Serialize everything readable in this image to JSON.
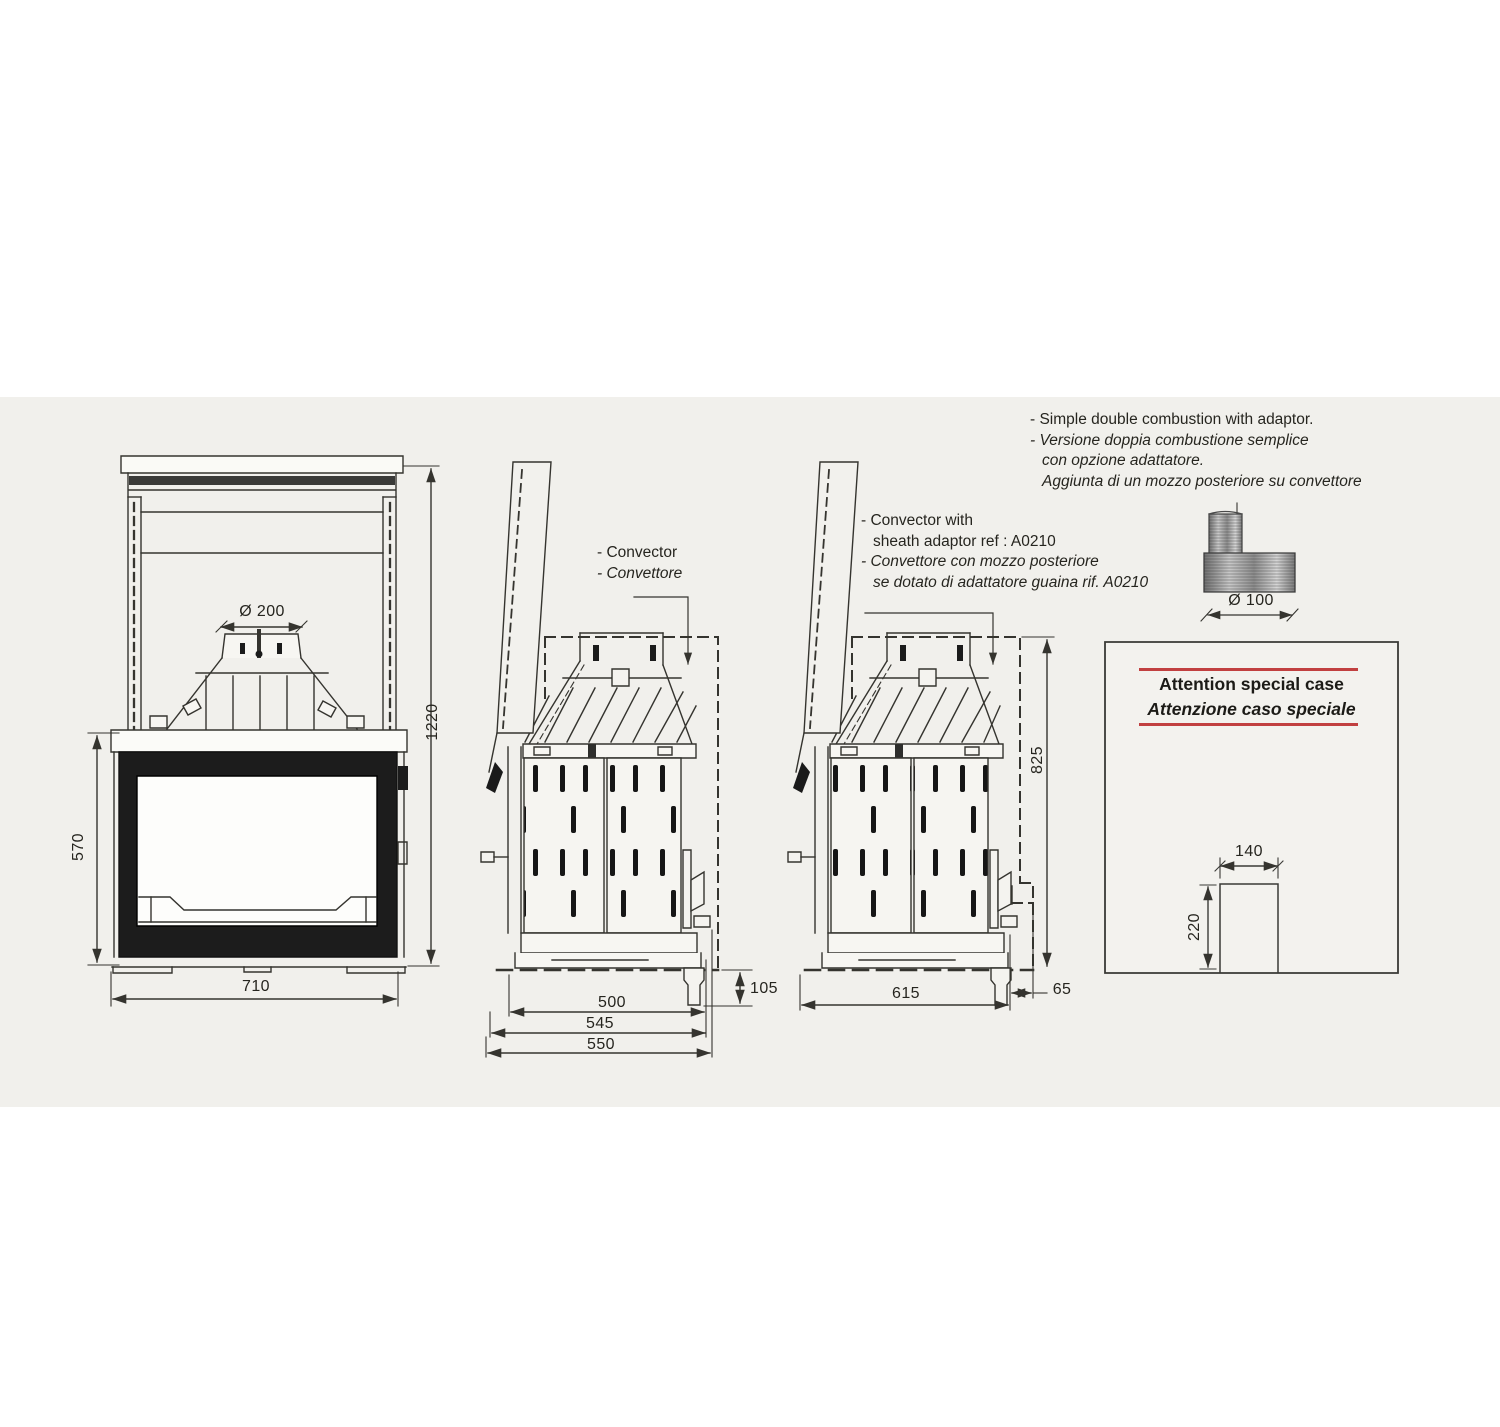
{
  "colors": {
    "scan_background": "#f1f0ec",
    "line": "#35342f",
    "firebox_black": "#1c1c1c",
    "accent_red": "#c14040"
  },
  "notes": {
    "simple_combustion": {
      "line1": "- Simple double combustion with adaptor.",
      "line2": "- Versione doppia combustione semplice",
      "line3": "con opzione adattatore.",
      "line4": "Aggiunta di un mozzo posteriore su convettore"
    },
    "convector_with_adaptor": {
      "line1": "- Convector with",
      "line2": "sheath adaptor ref : A0210",
      "line3": "- Convettore  con mozzo posteriore",
      "line4": "se dotato di adattatore guaina  rif. A0210"
    },
    "convector": {
      "line1": "- Convector",
      "line2": "- Convettore"
    }
  },
  "front_view": {
    "flue_diameter": "Ø 200",
    "total_height": "1220",
    "firebox_height": "570",
    "width": "710"
  },
  "side_view_a": {
    "depth_body": "500",
    "depth_mid": "545",
    "depth_total": "550",
    "rear_drop": "105"
  },
  "side_view_b": {
    "height": "825",
    "depth": "615",
    "hub_offset": "65"
  },
  "adaptor": {
    "diameter": "Ø 100"
  },
  "attention": {
    "title_en": "Attention special case",
    "title_it": "Attenzione caso speciale",
    "niche_width": "140",
    "niche_height": "220"
  }
}
